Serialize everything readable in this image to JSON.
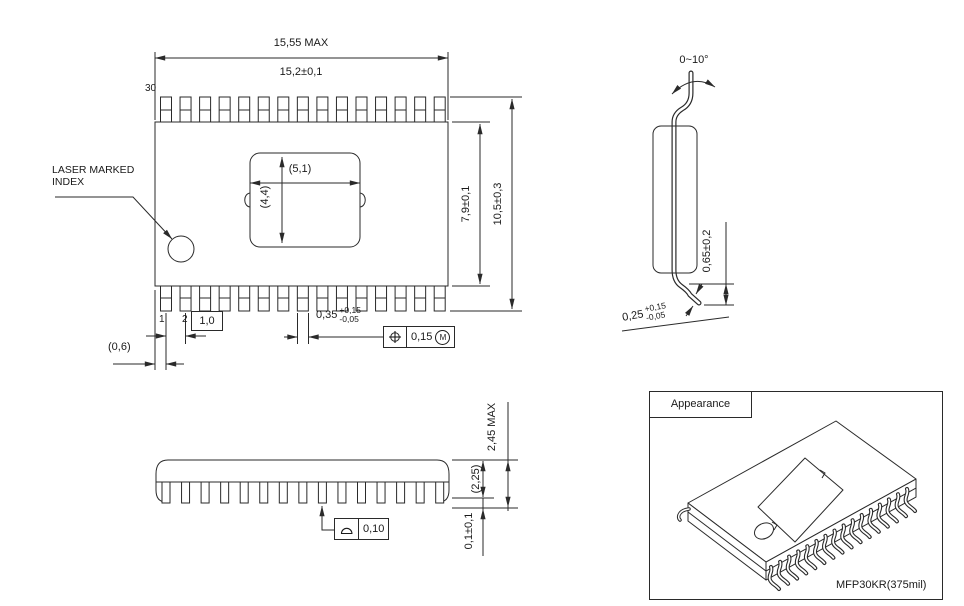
{
  "top_view": {
    "overall_width": "15,55 MAX",
    "body_width": "15,2±0,1",
    "pin30": "30",
    "pin1": "1",
    "pin2": "2",
    "pad_width": "(5,1)",
    "pad_height": "(4,4)",
    "laser_note": "LASER MARKED\nINDEX",
    "body_height": "7,9±0,1",
    "lead_span": "10,5±0,3",
    "pitch": "1,0",
    "edge_to_pin1": "(0,6)",
    "lead_width": {
      "value": "0,35",
      "plus": "+0,15",
      "minus": "-0,05"
    },
    "position_fcf": {
      "symbol": "position",
      "value": "0,15",
      "modifier": "M"
    }
  },
  "end_view": {
    "lead_angle": "0~10°",
    "lead_height": "0,65±0,2",
    "foot": {
      "value": "0,25",
      "plus": "+0,15",
      "minus": "-0,05"
    }
  },
  "side_view": {
    "total_height": "2,45 MAX",
    "body_thickness": "(2,25)",
    "standoff": "0,1±0,1",
    "flatness_fcf": {
      "symbol": "profile-of-surface",
      "value": "0,10"
    }
  },
  "appearance": {
    "title": "Appearance",
    "package_name": "MFP30KR(375mil)"
  },
  "package": {
    "pin_count_per_side": 15,
    "total_pins": 30
  },
  "colors": {
    "line": "#2a2a2a",
    "background": "#ffffff"
  }
}
